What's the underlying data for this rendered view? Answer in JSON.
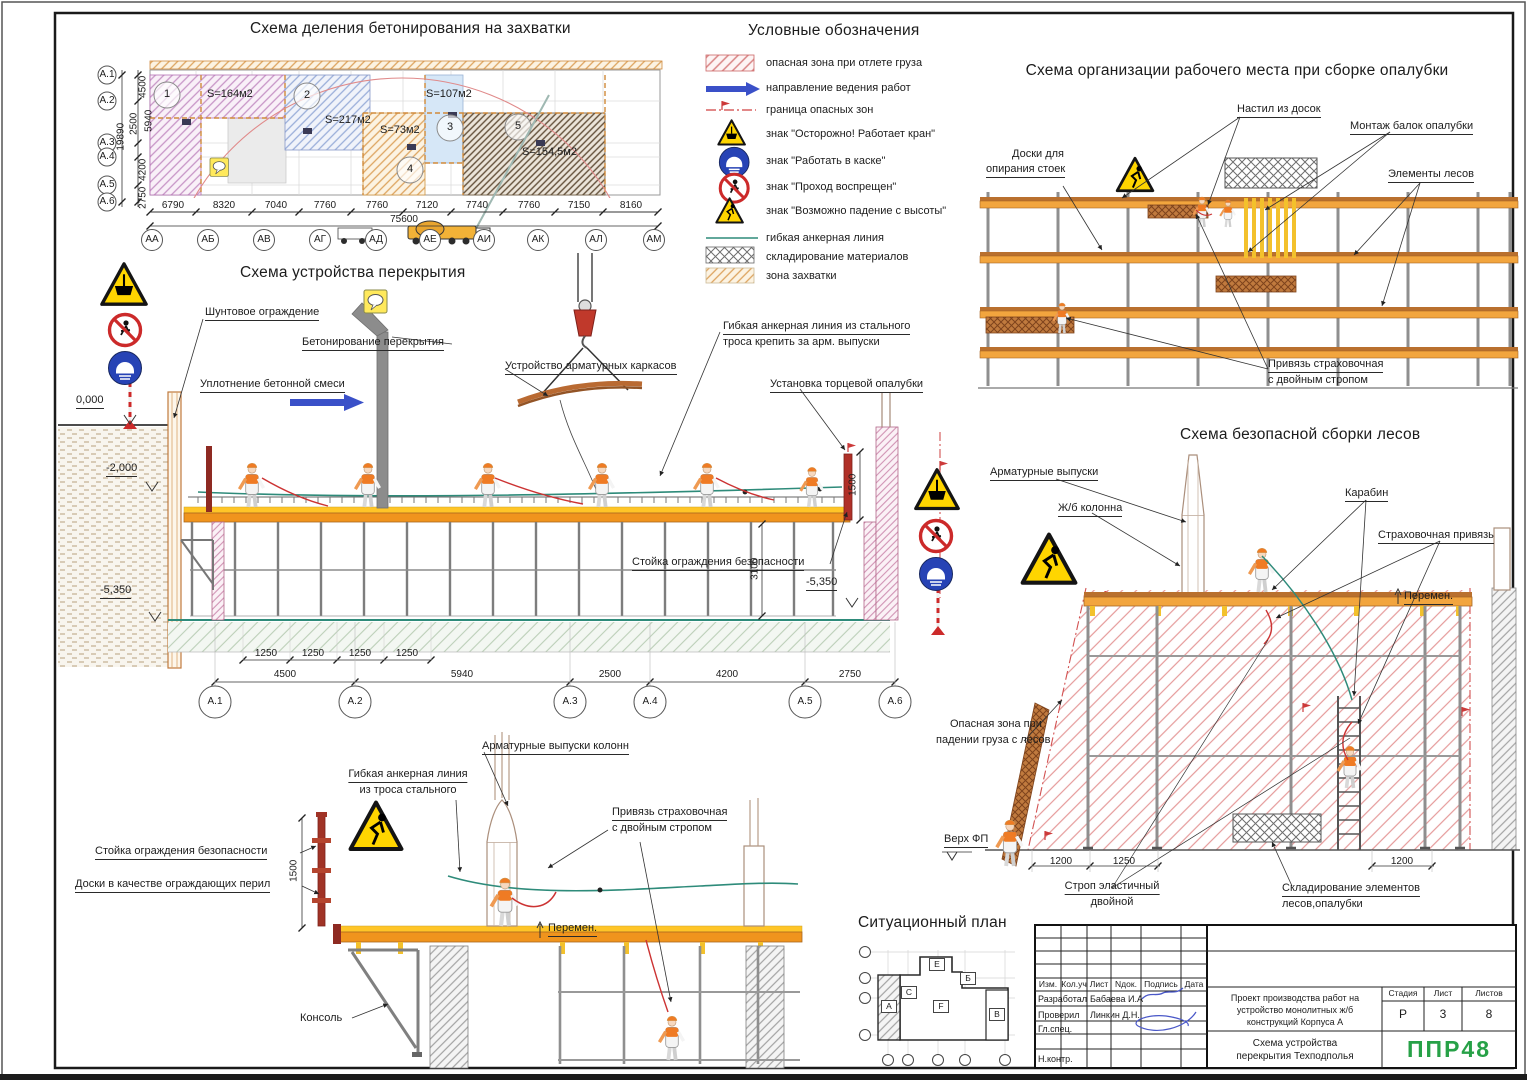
{
  "titles": {
    "plan": "Схема деления бетонирования на захватки",
    "legend": "Условные обозначения",
    "workplace": "Схема организации рабочего места при сборке опалубки",
    "slab": "Схема устройства перекрытия",
    "scaffold": "Схема безопасной сборки лесов",
    "situational": "Ситуационный план"
  },
  "plan": {
    "zones": [
      {
        "num": "1",
        "area": "S=164м2"
      },
      {
        "num": "2",
        "area": "S=217м2"
      },
      {
        "num": "3",
        "area": "S=107м2"
      },
      {
        "num": "4",
        "area": "S=73м2"
      },
      {
        "num": "5",
        "area": "S=154,5м2"
      }
    ],
    "col_dims": [
      "6790",
      "8320",
      "7040",
      "7760",
      "7760",
      "7120",
      "7740",
      "7760",
      "7150",
      "8160"
    ],
    "col_total": "75600",
    "col_axes": [
      "АА",
      "АБ",
      "АВ",
      "АГ",
      "АД",
      "АЕ",
      "АИ",
      "АК",
      "АЛ",
      "АМ"
    ],
    "row_axes": [
      "А.1",
      "А.2",
      "А.3",
      "А.4",
      "А.5",
      "А.6"
    ],
    "row_dims": [
      "4500",
      "5940",
      "2500",
      "4200",
      "2750"
    ],
    "row_total": "19890"
  },
  "legend": {
    "items": [
      "опасная зона при отлете груза",
      "направление ведения работ",
      "граница опасных зон",
      "знак \"Осторожно! Работает кран\"",
      "знак \"Работать в каске\"",
      "знак \"Проход воспрещен\"",
      "знак \"Возможно падение с высоты\"",
      "гибкая анкерная линия",
      "складирование материалов",
      "зона захватки"
    ]
  },
  "workplace": {
    "nastil": "Настил из досок",
    "montazh": "Монтаж балок опалубки",
    "doski1": "Доски для",
    "doski2": "опирания стоек",
    "elementy": "Элементы лесов",
    "privyaz1": "Привязь страховочная",
    "privyaz2": "с двойным стропом"
  },
  "slab": {
    "shuntovoe": "Шунтовое ограждение",
    "beton": "Бетонирование перекрытия",
    "uplotnenie": "Уплотнение бетонной смеси",
    "karkas": "Устройство арматурных каркасов",
    "anker1": "Гибкая анкерная линия из стального",
    "anker2": "троса крепить за арм. выпуски",
    "torec": "Установка торцевой опалубки",
    "stoika": "Стойка ограждения безопасности",
    "elev0": "0,000",
    "elev2": "-2,000",
    "elev5": "-5,350",
    "elev5r": "-5,350",
    "dim3100": "3100",
    "dim1500": "1500",
    "dim1250": "1250",
    "dims": [
      "4500",
      "5940",
      "2500",
      "4200",
      "2750"
    ],
    "axes": [
      "А.1",
      "А.2",
      "А.3",
      "А.4",
      "А.5",
      "А.6"
    ]
  },
  "scaffold": {
    "vypuski": "Арматурные выпуски",
    "kolonna": "Ж/б колонна",
    "karabin": "Карабин",
    "privyaz": "Страховочная привязь",
    "peremen": "Перемен.",
    "opasnaya1": "Опасная зона при",
    "opasnaya2": "падении груза с лесов",
    "verh": "Верх ФП",
    "strop1": "Строп эластичный",
    "strop2": "двойной",
    "sklad1": "Складирование элементов",
    "sklad2": "лесов,опалубки",
    "dim_a": "1200",
    "dim_b": "1250",
    "dim_c": "1200"
  },
  "parapet": {
    "vypuski": "Арматурные выпуски колонн",
    "anker1": "Гибкая анкерная линия",
    "anker2": "из троса стального",
    "stoika": "Стойка ограждения безопасности",
    "doski": "Доски в качестве ограждающих перил",
    "privyaz1": "Привязь страховочная",
    "privyaz2": "с двойным стропом",
    "peremen": "Перемен.",
    "konsol": "Консоль",
    "dim1500": "1500"
  },
  "situational": {
    "blocks": {
      "a": "А",
      "b": "Б",
      "v": "В",
      "e": "Е",
      "s": "С",
      "f": "F"
    }
  },
  "titleblock": {
    "cols": [
      "Изм.",
      "Кол.уч",
      "Лист",
      "Nдок.",
      "Подпись",
      "Дата"
    ],
    "rows": [
      {
        "role": "Разработал",
        "name": "Бабаева И.А"
      },
      {
        "role": "Проверил",
        "name": "Линкин Д.Н."
      },
      {
        "role": "Гл.спец.",
        "name": ""
      },
      {
        "role": "Н.контр.",
        "name": ""
      }
    ],
    "project": "Проект производства работ на устройство монолитных ж/б конструкций Корпуса А",
    "stage_label": "Стадия",
    "sheet_label": "Лист",
    "sheets_label": "Листов",
    "stage": "Р",
    "sheet": "3",
    "sheets": "8",
    "drawing1": "Схема устройства",
    "drawing2": "перекрытия Техподполья",
    "logo": "ППР48"
  },
  "colors": {
    "formwork_orange": "#f0941d",
    "formwork_yellow": "#ffc527",
    "wood": "#c07a3e",
    "steel": "#8a8a8a",
    "danger_red": "#cc2a2a",
    "anchor_teal": "#2e8b7a",
    "sign_yellow": "#ffd500",
    "sign_blue": "#2743b5",
    "logo_green": "#27a147"
  }
}
